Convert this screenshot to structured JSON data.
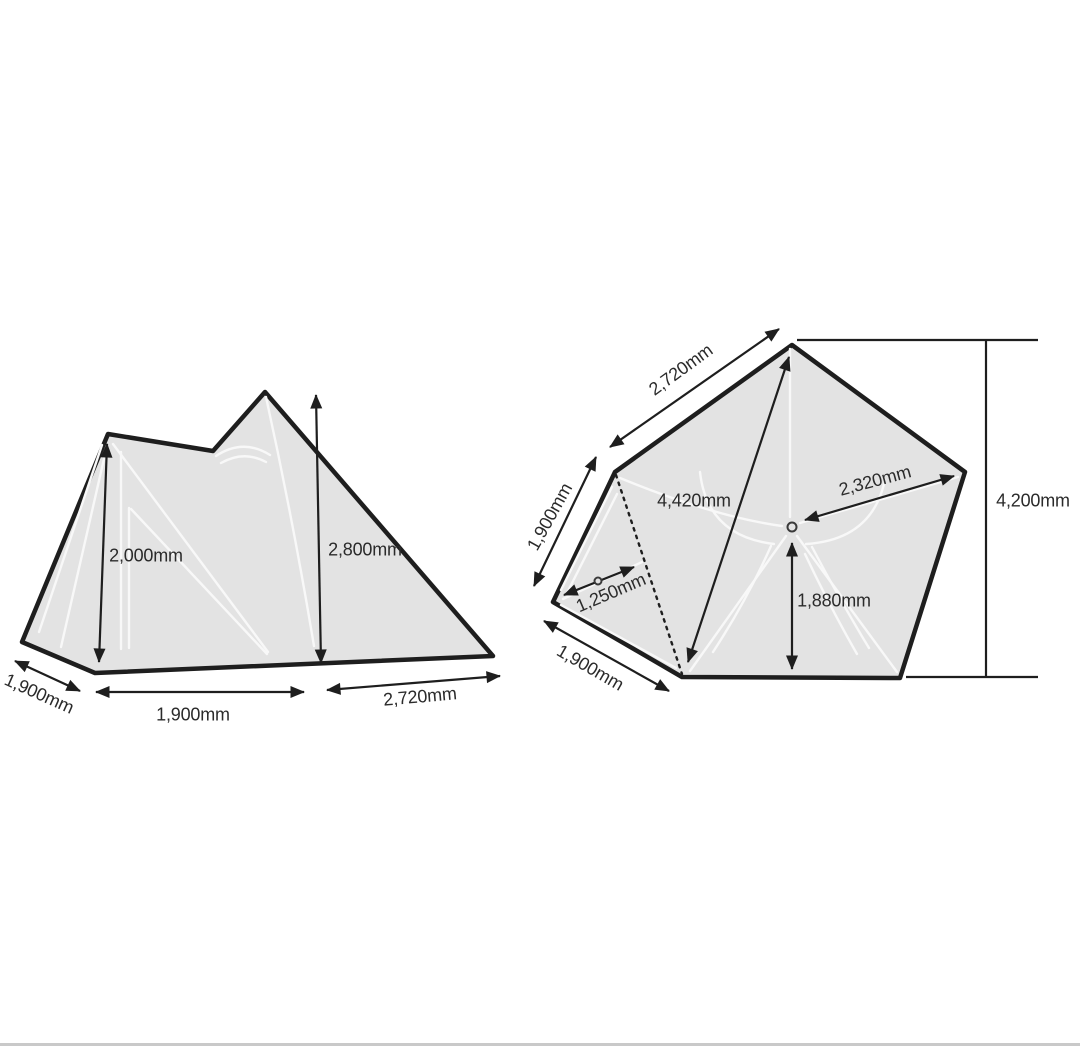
{
  "diagram": {
    "description": "Tent specification diagram: side elevation view and pentagonal floor plan with dimensions",
    "colors": {
      "background": "#ffffff",
      "outline": "#1e1e1e",
      "fill": "#e3e3e3",
      "seam": "#f8f8f8",
      "label": "#2b2b2b",
      "footer": "#c9c9c9"
    },
    "side_view": {
      "labels": {
        "inner_height": "2,000mm",
        "peak_height": "2,800mm",
        "floor_depth": "1,900mm",
        "front_width": "1,900mm",
        "rear_panel": "2,720mm"
      }
    },
    "floor_plan": {
      "labels": {
        "edge_top": "2,720mm",
        "edge_upper_left": "1,900mm",
        "edge_lower_left": "1,900mm",
        "long_diagonal": "4,420mm",
        "center_to_corner": "2,320mm",
        "center_to_edge": "1,880mm",
        "porch_depth": "1,250mm",
        "overall_width": "4,200mm"
      }
    }
  }
}
